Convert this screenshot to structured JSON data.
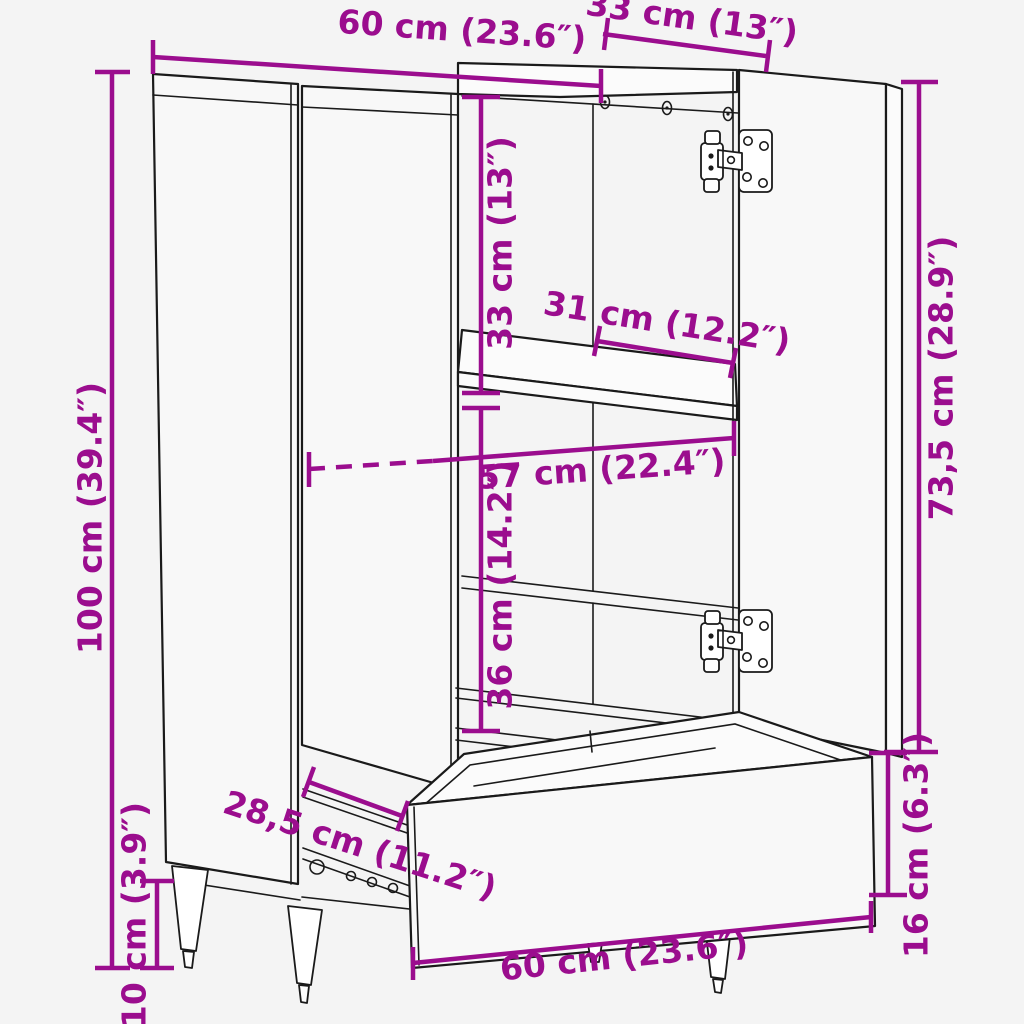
{
  "figure": {
    "type": "product-dimension-diagram",
    "subject": "cabinet line drawing with two open doors and open bottom drawer",
    "colors": {
      "dimension": "#9b0d8e",
      "line": "#1a1a1a",
      "background": "#f4f4f4"
    },
    "dimensions": {
      "top_width": {
        "cm": "60",
        "inches": "23.6",
        "label": "60 cm (23.6″)"
      },
      "top_depth": {
        "cm": "33",
        "inches": "13",
        "label": "33 cm (13″)"
      },
      "total_height": {
        "cm": "100",
        "inches": "39.4",
        "label": "100 cm (39.4″)"
      },
      "upper_compartment_height": {
        "cm": "33",
        "inches": "13",
        "label": "33 cm (13″)"
      },
      "shelf_width": {
        "cm": "31",
        "inches": "12.2",
        "label": "31 cm (12.2″)"
      },
      "interior_width": {
        "cm": "57",
        "inches": "22.4",
        "label": "57 cm (22.4″)"
      },
      "lower_compartment_height": {
        "cm": "36",
        "inches": "14.2",
        "label": "36 cm (14.2″)"
      },
      "door_height": {
        "cm": "73,5",
        "inches": "28.9",
        "label": "73,5 cm (28.9″)"
      },
      "drawer_height": {
        "cm": "16",
        "inches": "6.3",
        "label": "16 cm (6.3″)"
      },
      "drawer_slide_depth": {
        "cm": "28,5",
        "inches": "11.2",
        "label": "28,5 cm (11.2″)"
      },
      "leg_height": {
        "cm": "10",
        "inches": "3.9",
        "label": "10 cm (3.9″)"
      },
      "drawer_width": {
        "cm": "60",
        "inches": "23.6",
        "label": "60 cm (23.6″)"
      }
    }
  }
}
